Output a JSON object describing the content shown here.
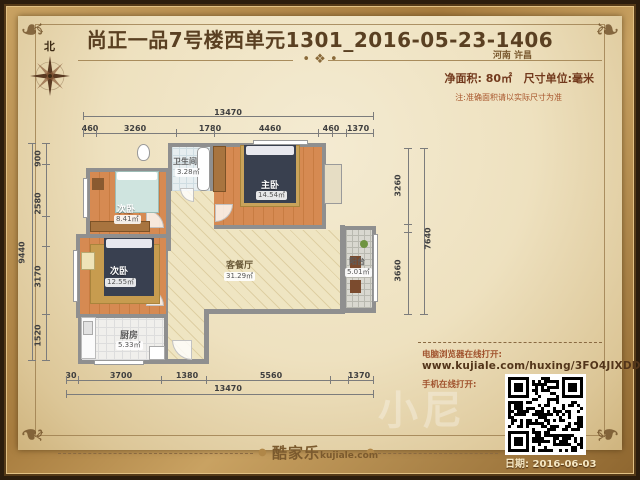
{
  "header": {
    "title": "尚正一品7号楼西单元1301_2016-05-23-1406",
    "location": "河南 许昌",
    "area_label": "净面积: 80㎡",
    "unit_label": "尺寸单位:毫米",
    "note": "注:准确面积请以实际尺寸为准",
    "separator_ornament": "• ❖ •"
  },
  "compass": {
    "north_label": "北"
  },
  "rooms": [
    {
      "name": "卫生间",
      "area": "3.28㎡"
    },
    {
      "name": "主卧",
      "area": "14.54㎡"
    },
    {
      "name": "次卧",
      "area": "8.41㎡"
    },
    {
      "name": "次卧",
      "area": "12.55㎡"
    },
    {
      "name": "厨房",
      "area": "5.33㎡"
    },
    {
      "name": "客餐厅",
      "area": "31.29㎡"
    },
    {
      "name": "阳台",
      "area": "5.01㎡"
    }
  ],
  "dimensions": {
    "top_total": "13470",
    "top_segments": [
      "460",
      "3260",
      "1780",
      "4460",
      "460",
      "1370"
    ],
    "bottom_total": "13470",
    "bottom_segments": [
      "30",
      "3700",
      "1380",
      "5560",
      "1370"
    ],
    "left_total": "9440",
    "left_segments": [
      "900",
      "2580",
      "3170",
      "1520"
    ],
    "right_total": "7640",
    "right_segments": [
      "3260",
      "3660"
    ]
  },
  "footer": {
    "logo_cn": "酷家乐",
    "logo_en": "kujiale.com",
    "open_pc_label": "电脑浏览器在线打开:",
    "url": "www.kujiale.com/huxing/3FO4JIXDDNP0",
    "open_mobile_label": "手机在线打开:",
    "date": "日期: 2016-06-03"
  },
  "watermark": "小尼",
  "colors": {
    "frame_gold": "#b58a48",
    "parchment": "#eee1bf",
    "title_brown": "#5a4022",
    "accent_red_brown": "#a0522d",
    "wall_gray": "#8f8f8f",
    "wood_floor": "#d0824a",
    "living_floor": "#efe5c2"
  }
}
